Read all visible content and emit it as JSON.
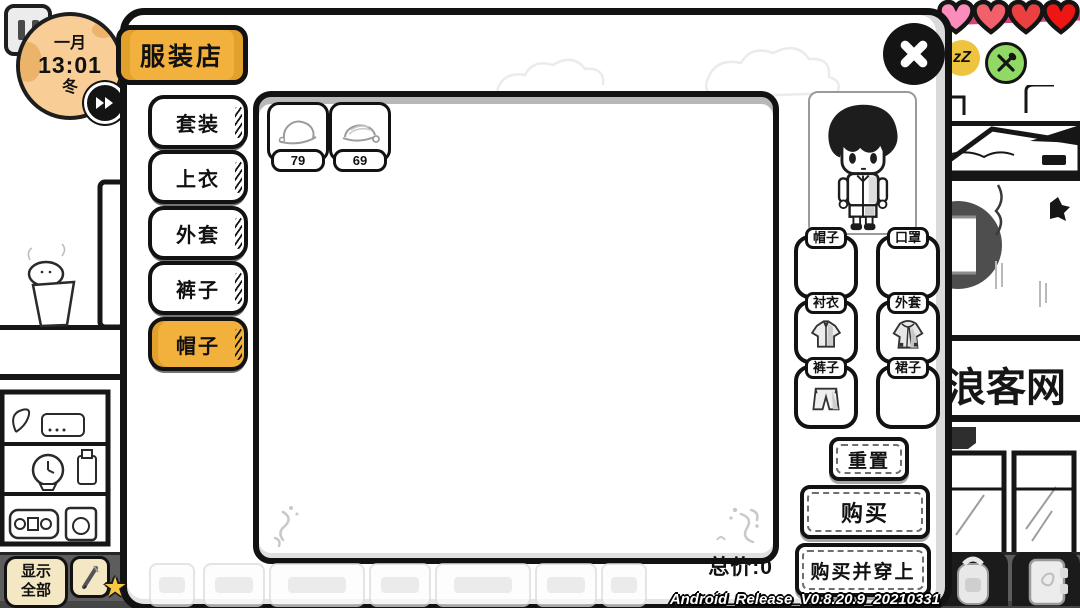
{
  "hud": {
    "clock": {
      "month": "一月",
      "time": "13:01",
      "season": "冬"
    },
    "hearts": {
      "colors": [
        "#fb8cbb",
        "#f2606b",
        "#ea4040",
        "#ef1515"
      ]
    },
    "status": {
      "sleep_text": "zZ"
    },
    "hotbar": {
      "show_all_line1": "显示",
      "show_all_line2": "全部"
    },
    "version": "Android_Release_V0.8.20.9_20210331"
  },
  "shop": {
    "title": "服装店",
    "categories": [
      {
        "label": "套装",
        "selected": false
      },
      {
        "label": "上衣",
        "selected": false
      },
      {
        "label": "外套",
        "selected": false
      },
      {
        "label": "裤子",
        "selected": false
      },
      {
        "label": "帽子",
        "selected": true
      }
    ],
    "items": [
      {
        "name": "cap",
        "price": "79"
      },
      {
        "name": "beanie",
        "price": "69"
      }
    ],
    "total": "总价:0",
    "equip_slots": [
      {
        "label": "帽子",
        "equipped": false
      },
      {
        "label": "口罩",
        "equipped": false
      },
      {
        "label": "衬衣",
        "equipped": true
      },
      {
        "label": "外套",
        "equipped": true
      },
      {
        "label": "裤子",
        "equipped": true
      },
      {
        "label": "裙子",
        "equipped": false
      }
    ],
    "actions": {
      "reset": "重置",
      "buy": "购买",
      "buy_and_wear": "购买并穿上"
    }
  },
  "background": {
    "shop_sign": "浪客网"
  },
  "colors": {
    "accent_gold": "#f2b13c",
    "heart_ribbon": "#d6447e",
    "sleep_yellow": "#eec33e",
    "food_green": "#8fd964"
  }
}
